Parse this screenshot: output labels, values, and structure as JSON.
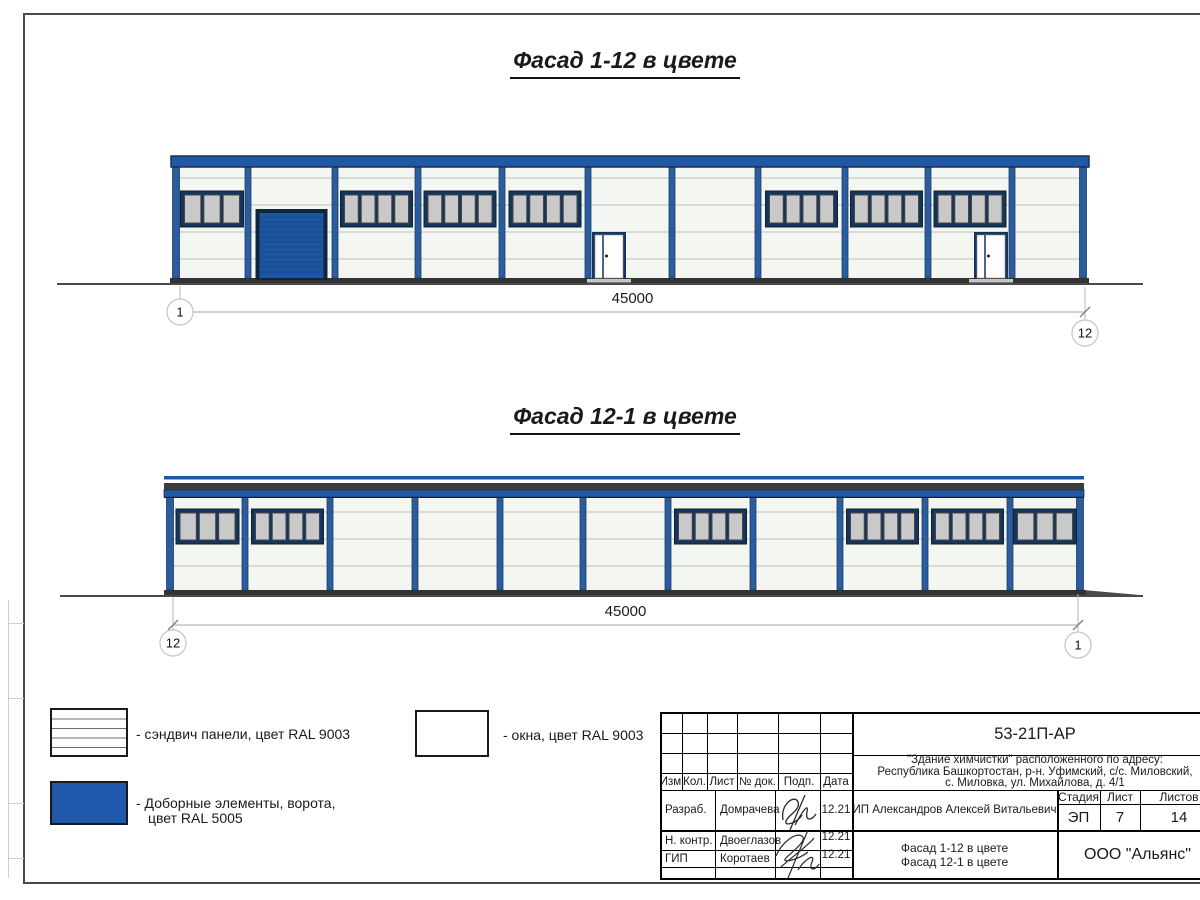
{
  "facades": [
    {
      "id": "facade-1-12",
      "title": "Фасад 1-12 в цвете",
      "dimension_label": "45000",
      "axis_left": "1",
      "axis_right": "12",
      "bays": [
        "window3",
        "gate",
        "window4",
        "window4",
        "window4",
        "door-left",
        "empty",
        "window4",
        "window4",
        "window4 door-right",
        "empty"
      ]
    },
    {
      "id": "facade-12-1",
      "title": "Фасад 12-1 в цвете",
      "dimension_label": "45000",
      "axis_left": "12",
      "axis_right": "1",
      "bays": [
        "window3",
        "window4",
        "empty",
        "empty",
        "empty",
        "empty",
        "window4",
        "empty",
        "window4",
        "window4",
        "window3"
      ]
    }
  ],
  "legend": {
    "items": [
      {
        "swatch": "sandwich-panels",
        "label": "- сэндвич панели, цвет RAL 9003"
      },
      {
        "swatch": "blue-elements",
        "label": "- Доборные элементы, ворота,",
        "label2": "цвет RAL 5005"
      },
      {
        "swatch": "windows",
        "label": "- окна, цвет RAL 9003"
      }
    ]
  },
  "title_block": {
    "code": "53-21П-АР",
    "project_line1": "\"Здание химчистки\" расположенного по адресу:",
    "project_line2": "Республика Башкортостан, р-н. Уфимский, с/с. Миловский,",
    "project_line3": "с. Миловка, ул. Михайлова, д. 4/1",
    "columns": [
      "Изм.",
      "Кол.",
      "Лист",
      "№ док.",
      "Подп.",
      "Дата"
    ],
    "rows": [
      {
        "role": "Разраб.",
        "name": "Домрачева",
        "date": "12.21"
      },
      {
        "role": "Н. контр.",
        "name": "Двоеглазов",
        "date": "12.21"
      },
      {
        "role": "ГИП",
        "name": "Коротаев",
        "date": "12.21"
      }
    ],
    "client": "ИП Александров Алексей Витальевич",
    "stage_label": "Стадия",
    "stage_value": "ЭП",
    "sheet_label": "Лист",
    "sheet_value": "7",
    "sheets_label": "Листов",
    "sheets_value": "14",
    "sheet_title_line1": "Фасад 1-12 в цвете",
    "sheet_title_line2": "Фасад 12-1 в цвете",
    "company": "ООО \"Альянс\""
  },
  "colors": {
    "frame_blue": "#2257a3",
    "column_blue": "#2b5c9d",
    "gate_blue": "#1e55a0",
    "legend_blue": "#2058ab",
    "panel": "#f3f6f1",
    "panel_line": "#bdc3bd",
    "window_pane": "#c9c9c9",
    "navy": "#15355a",
    "dark_band": "#3c3c3c",
    "ground": "#333333"
  }
}
